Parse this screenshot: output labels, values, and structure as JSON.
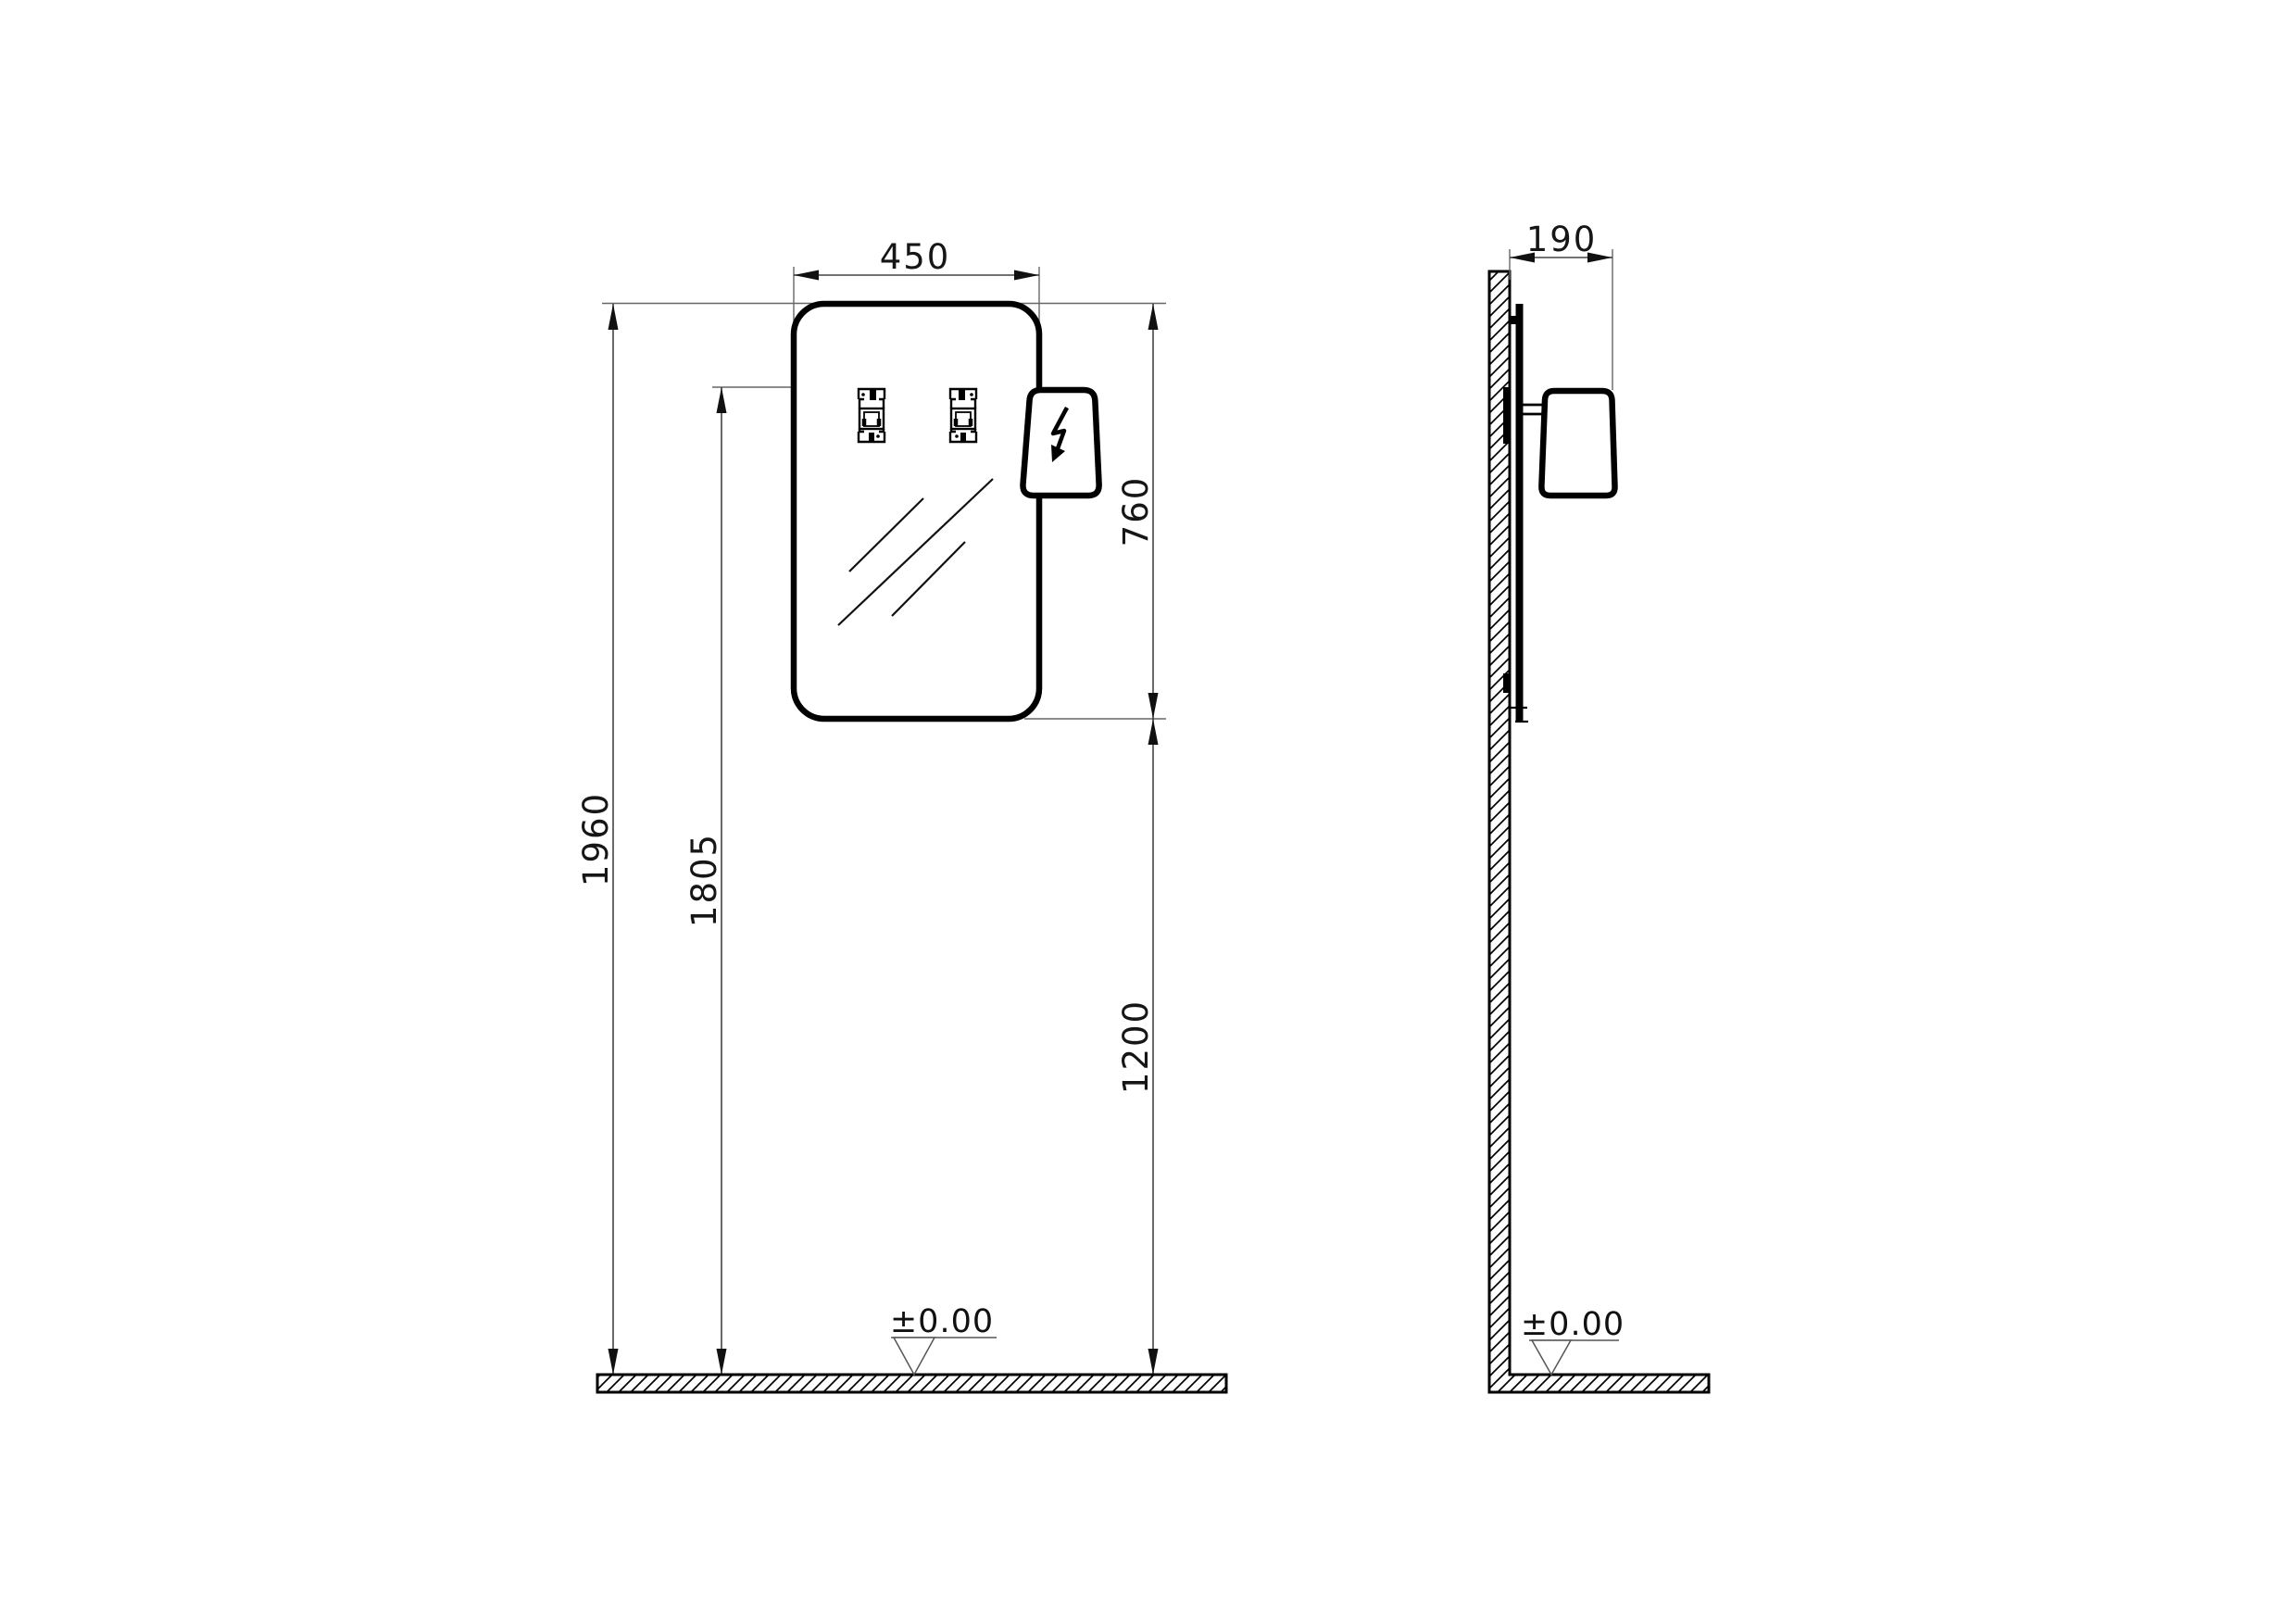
{
  "drawing_title": "mirror-with-lamp-technical-drawing",
  "front_view": {
    "dims": {
      "width": "450",
      "hanger_spacing": "170",
      "mirror_height": "760",
      "overall_height": "1960",
      "hanger_height": "1805",
      "mirror_bottom_to_floor": "1200"
    },
    "floor_level": "±0.00"
  },
  "side_view": {
    "dims": {
      "depth": "190"
    },
    "floor_level": "±0.00"
  },
  "colors": {
    "line": "#000000",
    "dimension_line": "#444444",
    "extension_line": "#666666",
    "text": "#161616",
    "background": "#ffffff"
  },
  "icons": {
    "lamp_symbol": "lightning-bolt"
  }
}
